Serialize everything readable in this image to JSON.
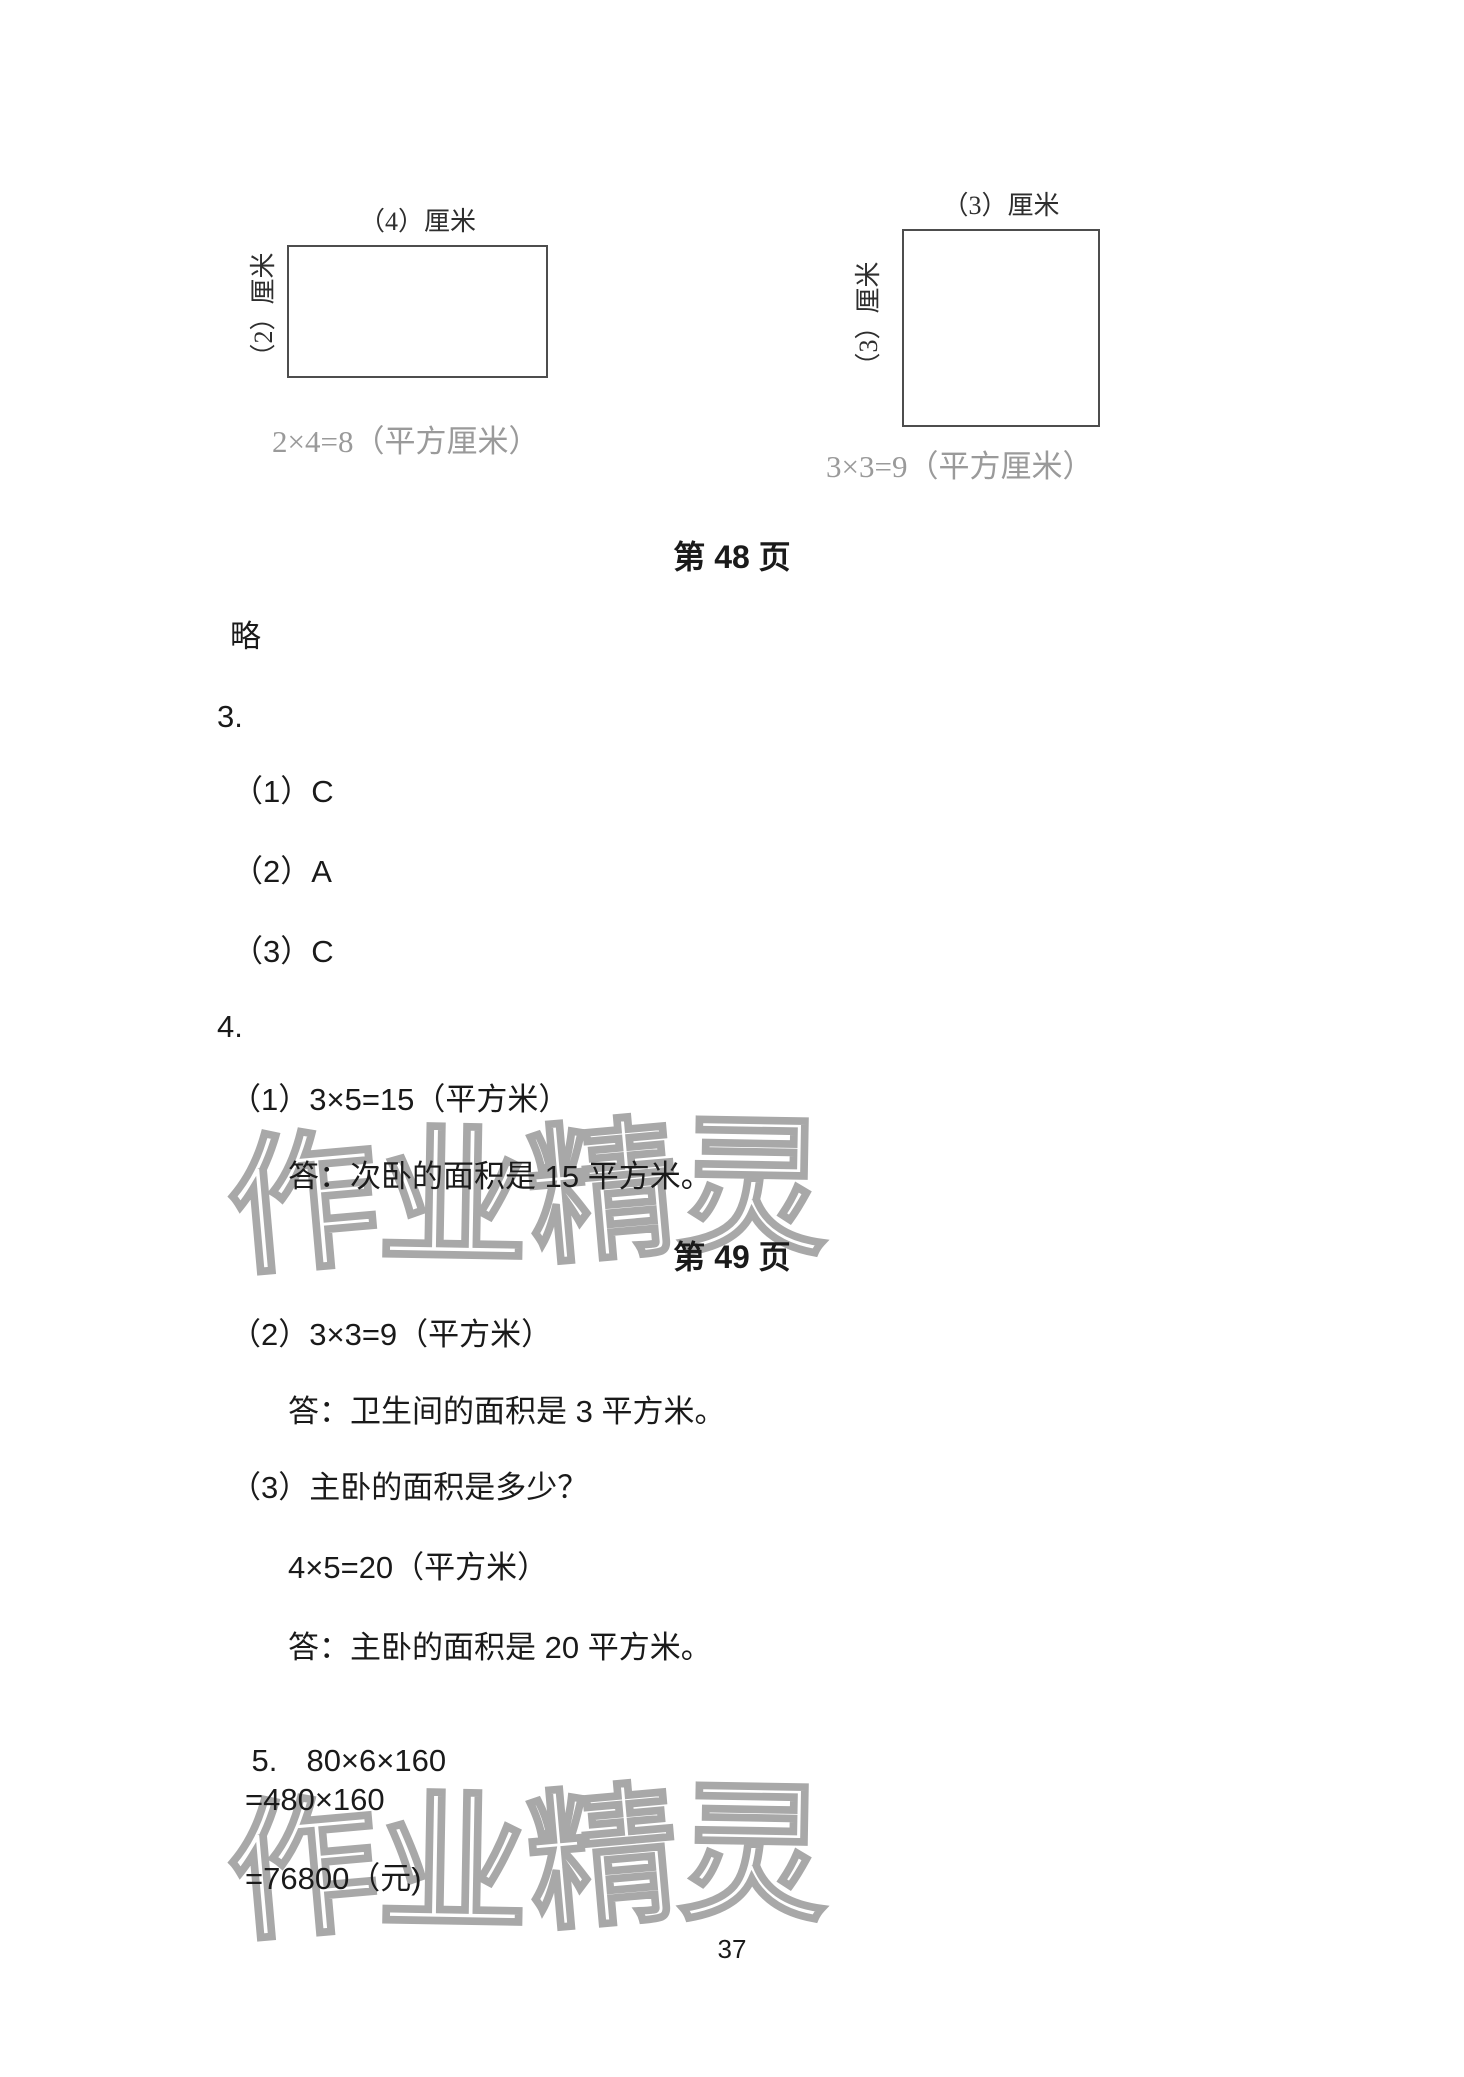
{
  "page": {
    "page_number": "37"
  },
  "watermark": {
    "text": "作业精灵"
  },
  "diagrams": {
    "rect": {
      "top_label": "（4）厘米",
      "side_label": "（2）厘米",
      "equation": "2×4=8（平方厘米）"
    },
    "square": {
      "top_label": "（3）厘米",
      "side_label": "（3）厘米",
      "equation": "3×3=9（平方厘米）"
    }
  },
  "headings": {
    "page48": "第 48 页",
    "page49": "第 49 页"
  },
  "answers": {
    "skip": "略",
    "q3": {
      "number": "3.",
      "items": [
        "（1）C",
        "（2）A",
        "（3）C"
      ]
    },
    "q4": {
      "number": "4.",
      "item1": "（1）3×5=15（平方米）",
      "answer1": "答：次卧的面积是 15 平方米。",
      "item2": "（2）3×3=9（平方米）",
      "answer2": "答：卫生间的面积是 3 平方米。",
      "item3": "（3）主卧的面积是多少？",
      "work3": "4×5=20（平方米）",
      "answer3": "答：主卧的面积是 20 平方米。"
    },
    "q5": {
      "number": "5.",
      "expression": "80×6×160",
      "step1": "=480×160",
      "step2": "=76800（元)"
    }
  }
}
